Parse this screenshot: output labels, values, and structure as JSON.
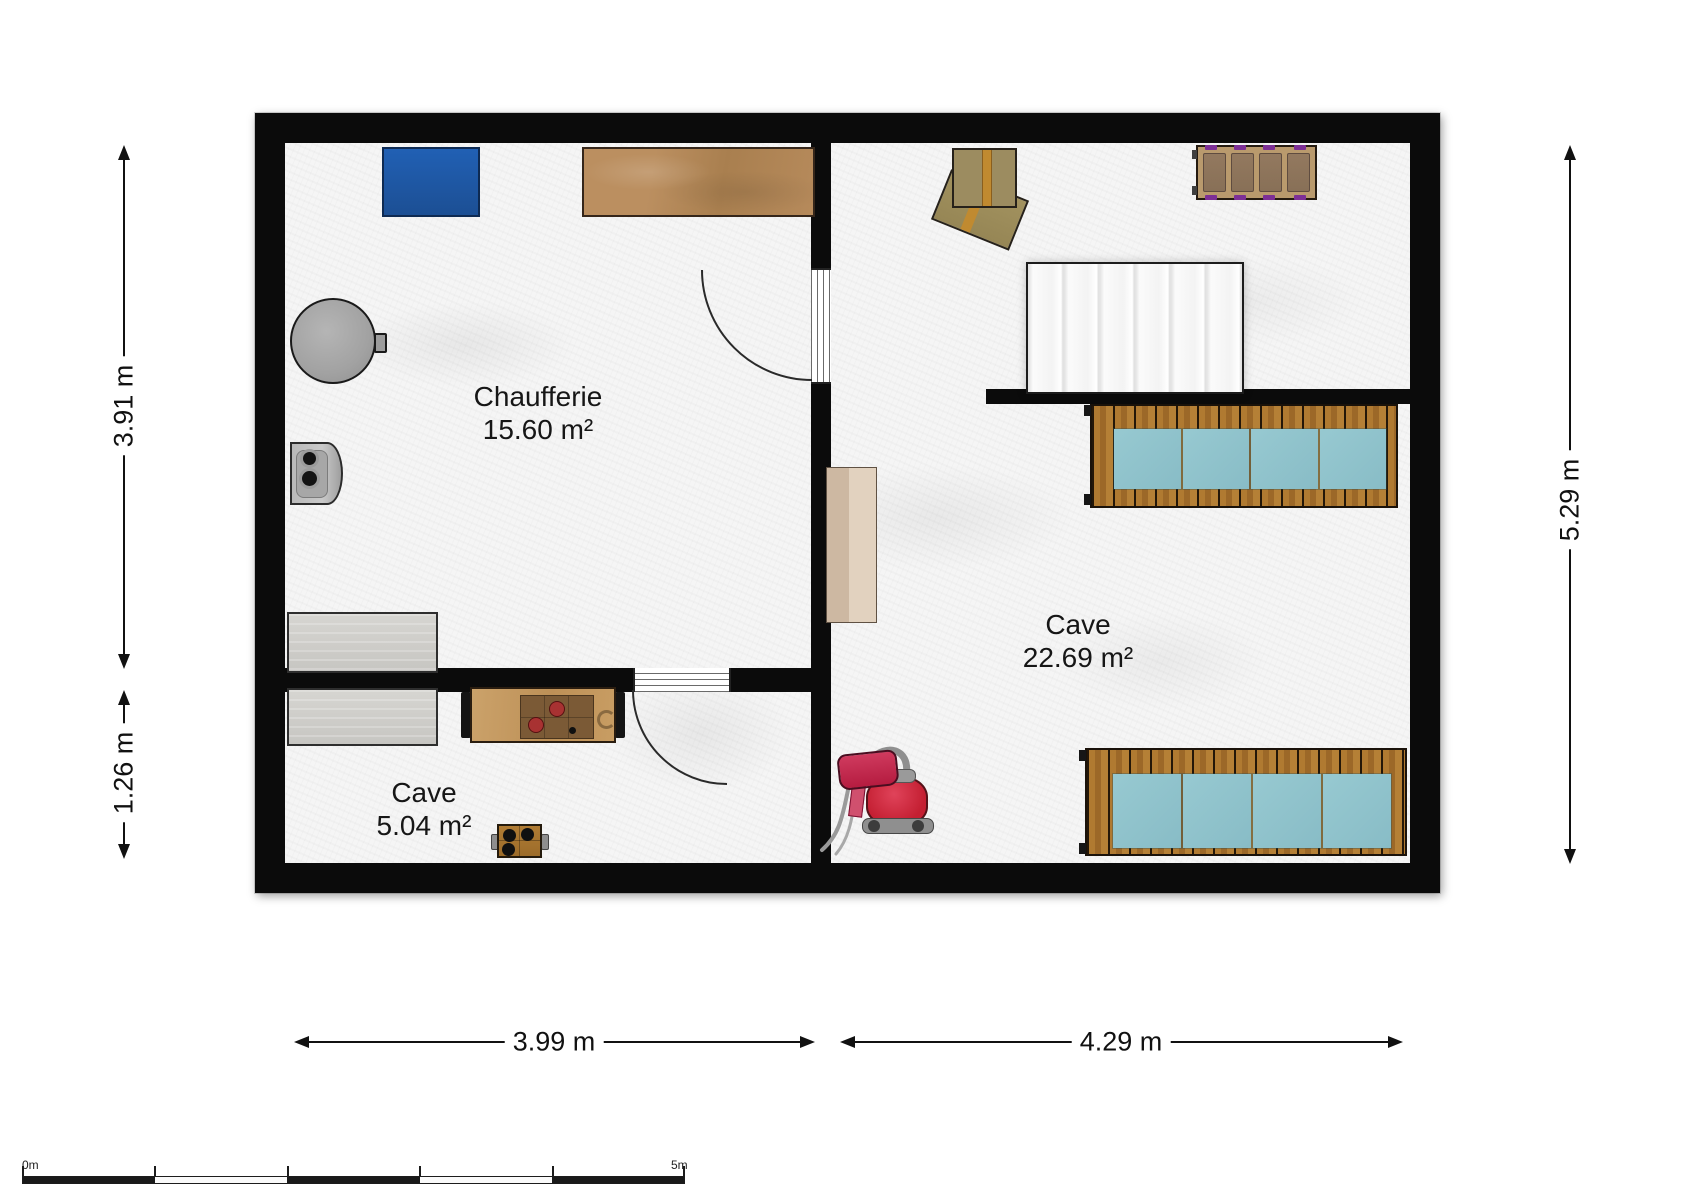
{
  "plan": {
    "rooms": [
      {
        "name": "Chaufferie",
        "area": "15.60 m²"
      },
      {
        "name": "Cave",
        "area": "22.69 m²"
      },
      {
        "name": "Cave",
        "area": "5.04 m²"
      }
    ],
    "dimensions": {
      "left_upper": "3.91 m",
      "left_lower": "1.26 m",
      "right": "5.29 m",
      "bottom_left": "3.99 m",
      "bottom_right": "4.29 m"
    },
    "scale_bar": {
      "start_label": "0m",
      "end_label": "5m"
    },
    "furniture": [
      "blue-storage-box",
      "wooden-table",
      "boiler-tank",
      "water-heater",
      "cardboard-boxes",
      "slatted-bench",
      "staircase",
      "deck-bench-upper",
      "deck-bench-lower",
      "shelf-cabinet",
      "gray-table-upper",
      "gray-table-lower",
      "workbench",
      "camping-stove",
      "vacuum-cleaner"
    ],
    "colors": {
      "wall": "#0b0b0b",
      "floor": "#f5f5f5",
      "blue_box": "#1e55a3",
      "wood_table": "#b28557",
      "deck_wood": "#a9742e",
      "cushion": "#8fc3cc",
      "purple_accent": "#7d2f96",
      "vacuum_red": "#c32040",
      "cardboard": "#9c8c60",
      "stairs": "#f4f4f4"
    }
  }
}
